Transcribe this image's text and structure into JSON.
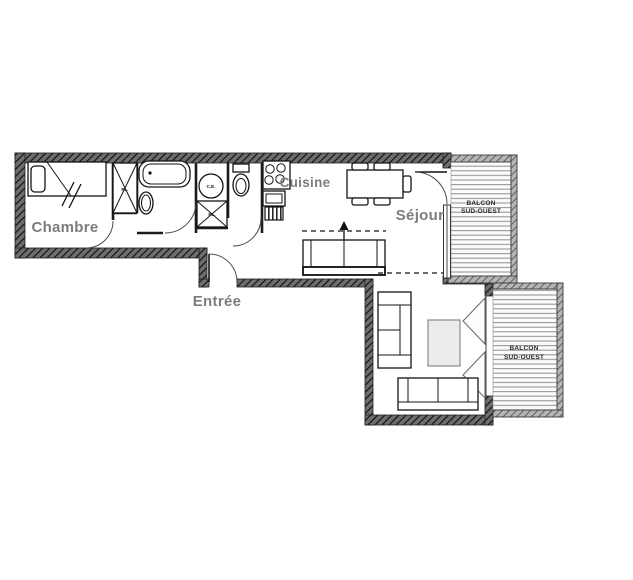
{
  "floor_plan": {
    "rooms": {
      "chambre": "Chambre",
      "cuisine": "Cuisine",
      "sejour": "Séjour",
      "entree": "Entrée"
    },
    "balcony_top": {
      "line1": "BALCON",
      "line2": "SUD-OUEST"
    },
    "balcony_bottom": {
      "line1": "BALCON",
      "line2": "SUD-OUEST"
    },
    "labels": {
      "water_heater": "C.E.",
      "closet": "PL."
    },
    "colors": {
      "wall": "#6e6e6e",
      "wall_hatch": "#141414",
      "room_label": "#7d7d7d",
      "balcony_stripe": "#8f8f8f",
      "line": "#141414",
      "background": "#ffffff"
    }
  }
}
